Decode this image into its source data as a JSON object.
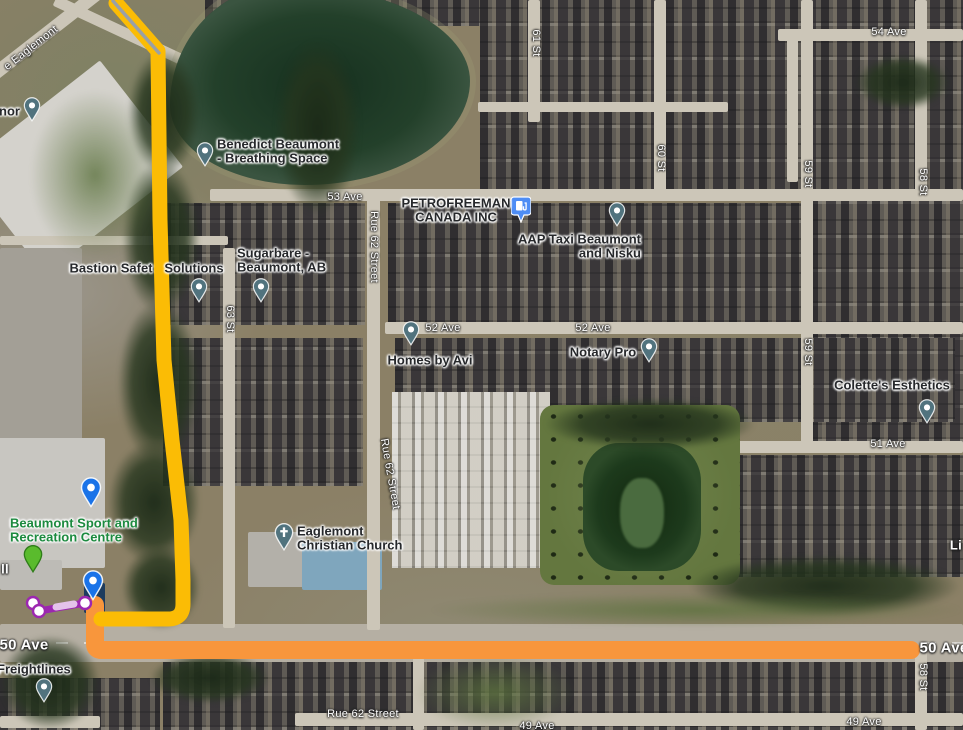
{
  "map": {
    "type": "google-maps-satellite-with-route",
    "width": 963,
    "height": 730
  },
  "colors": {
    "route_yellow": "#FBBC05",
    "route_orange": "#F8963C",
    "route_start_gray": "#9AA0A6",
    "walk_purple": "#9C27B0",
    "walk_purple_light": "#E4C2EA",
    "walk_node_fill": "#FFFFFF",
    "pin_blue": "#1A73E8",
    "pin_teal": "#51737E",
    "pin_green": "#5ABB2D",
    "pin_green_stroke": "#2F7D19",
    "pin_gas_blue": "#4E8DF5",
    "selected_building_navy": "#1D3C5E",
    "poi_text": "#26282B",
    "road_text": "#FFFFFF",
    "recreation_green": "#1C8A3F"
  },
  "road_labels": [
    {
      "t": "e Eaglemont",
      "x": 31,
      "y": 48,
      "r": -38
    },
    {
      "t": "54 Ave",
      "x": 889,
      "y": 32
    },
    {
      "t": "61 St",
      "x": 536,
      "y": 43,
      "r": 90
    },
    {
      "t": "60 St",
      "x": 661,
      "y": 158,
      "r": 90
    },
    {
      "t": "59 St",
      "x": 808,
      "y": 174,
      "r": 90
    },
    {
      "t": "58 St",
      "x": 923,
      "y": 182,
      "r": 90
    },
    {
      "t": "53 Ave",
      "x": 345,
      "y": 197
    },
    {
      "t": "Rue 62 Street",
      "x": 374,
      "y": 247,
      "r": 90
    },
    {
      "t": "52 Ave",
      "x": 443,
      "y": 328
    },
    {
      "t": "52 Ave",
      "x": 593,
      "y": 328
    },
    {
      "t": "63 St",
      "x": 230,
      "y": 319,
      "r": 90
    },
    {
      "t": "59 St",
      "x": 808,
      "y": 352,
      "r": 90
    },
    {
      "t": "51 Ave",
      "x": 888,
      "y": 444
    },
    {
      "t": "Rue 62 Street",
      "x": 390,
      "y": 474,
      "r": 80
    },
    {
      "t": "Li",
      "x": 956,
      "y": 545,
      "s": 13,
      "w": 700
    },
    {
      "t": "ll",
      "x": 5,
      "y": 569,
      "s": 13,
      "w": 700
    },
    {
      "t": "50 Ave",
      "x": 24,
      "y": 645,
      "s": 15,
      "w": 700
    },
    {
      "t": "50 Ave",
      "x": 944,
      "y": 648,
      "s": 15,
      "w": 700
    },
    {
      "t": "58 St",
      "x": 923,
      "y": 677,
      "r": 90
    },
    {
      "t": "Rue 62 Street",
      "x": 363,
      "y": 714
    },
    {
      "t": "49 Ave",
      "x": 537,
      "y": 726
    },
    {
      "t": "49 Ave",
      "x": 864,
      "y": 722
    }
  ],
  "place_labels": [
    {
      "n": "manor",
      "lines": [
        "nor"
      ],
      "x": 20,
      "y": 111,
      "align": "right"
    },
    {
      "n": "benedict-beaumont",
      "lines": [
        "Benedict Beaumont",
        "- Breathing Space"
      ],
      "x": 217,
      "y": 151,
      "align": "left"
    },
    {
      "n": "bastion-safety",
      "lines": [
        "Bastion Safet"
      ],
      "x": 111,
      "y": 268,
      "align": "center"
    },
    {
      "n": "bastion-solutions",
      "lines": [
        "Solutions"
      ],
      "x": 194,
      "y": 268,
      "align": "center"
    },
    {
      "n": "sugarbare",
      "lines": [
        "Sugarbare -",
        "Beaumont, AB"
      ],
      "x": 237,
      "y": 260,
      "align": "left"
    },
    {
      "n": "petrofreeman",
      "lines": [
        "PETROFREEMAN",
        "CANADA INC"
      ],
      "x": 456,
      "y": 210,
      "align": "center"
    },
    {
      "n": "aap-taxi",
      "lines": [
        "AAP Taxi Beaumont",
        "and Nisku"
      ],
      "x": 641,
      "y": 246,
      "align": "right"
    },
    {
      "n": "homes-by-avi",
      "lines": [
        "Homes by Avi"
      ],
      "x": 430,
      "y": 360,
      "align": "center"
    },
    {
      "n": "notary-pro",
      "lines": [
        "Notary Pro"
      ],
      "x": 603,
      "y": 352,
      "align": "center"
    },
    {
      "n": "colettes-esthetics",
      "lines": [
        "Colette's Esthetics"
      ],
      "x": 892,
      "y": 385,
      "align": "center"
    },
    {
      "n": "eaglemont-church",
      "lines": [
        "Eaglemont",
        "Christian Church"
      ],
      "x": 297,
      "y": 538,
      "align": "left"
    },
    {
      "n": "freightlines",
      "lines": [
        "Freightlines"
      ],
      "x": -3,
      "y": 669,
      "align": "left"
    },
    {
      "n": "recreation-centre",
      "lines": [
        "Beaumont Sport and",
        "Recreation Centre"
      ],
      "x": 10,
      "y": 530,
      "align": "left",
      "color": "#1C8A3F"
    }
  ],
  "pins": [
    {
      "n": "manor",
      "t": "teal",
      "x": 32,
      "y": 122
    },
    {
      "n": "benedict-beaumont",
      "t": "teal",
      "x": 205,
      "y": 167
    },
    {
      "n": "bastion-solutions",
      "t": "teal",
      "x": 199,
      "y": 303
    },
    {
      "n": "sugarbare",
      "t": "teal",
      "x": 261,
      "y": 303
    },
    {
      "n": "gas-station",
      "t": "gas",
      "x": 521,
      "y": 223
    },
    {
      "n": "aap-taxi",
      "t": "teal",
      "x": 617,
      "y": 227
    },
    {
      "n": "homes-by-avi",
      "t": "teal",
      "x": 411,
      "y": 346
    },
    {
      "n": "notary-pro",
      "t": "teal",
      "x": 649,
      "y": 363
    },
    {
      "n": "colettes-esthetics",
      "t": "teal",
      "x": 927,
      "y": 424
    },
    {
      "n": "eaglemont-church",
      "t": "church",
      "x": 284,
      "y": 552
    },
    {
      "n": "waypoint-north",
      "t": "blue",
      "x": 91,
      "y": 508
    },
    {
      "n": "waypoint-south",
      "t": "blue",
      "x": 93,
      "y": 601
    },
    {
      "n": "green-marker",
      "t": "green",
      "x": 33,
      "y": 574
    },
    {
      "n": "freightlines",
      "t": "teal",
      "x": 44,
      "y": 703
    }
  ],
  "routes": {
    "paths": [
      {
        "name": "route-orange-50ave",
        "d": "M95 605 L95 644 Q95 650 102 650 L911 650",
        "color": "#F8963C",
        "w": 18
      },
      {
        "name": "route-yellow-main",
        "d": "M116 3 L158 51 L160 220 L164 360 L172 440 L181 520 L183 580 L183 604 Q183 619 168 619 L101 619",
        "color": "#FBBC05",
        "w": 15
      },
      {
        "name": "route-start-gray",
        "d": "M113 1 L159 53",
        "color": "#9AA0A6",
        "w": 3.5
      },
      {
        "name": "route-walk-purple",
        "d": "M33 603 L39 611 L85 603",
        "color": "#9C27B0",
        "w": 7
      },
      {
        "name": "route-walk-light",
        "d": "M56 607 L74 604",
        "color": "#E4C2EA",
        "w": 7
      }
    ],
    "walk_nodes": [
      {
        "x": 33,
        "y": 603
      },
      {
        "x": 39,
        "y": 611
      },
      {
        "x": 85,
        "y": 603
      }
    ]
  },
  "map_features": {
    "zones": [
      {
        "x": 480,
        "y": 0,
        "w": 483,
        "h": 196
      },
      {
        "x": 205,
        "y": 0,
        "w": 275,
        "h": 26
      },
      {
        "x": 163,
        "y": 203,
        "w": 202,
        "h": 122
      },
      {
        "x": 388,
        "y": 203,
        "w": 575,
        "h": 122
      },
      {
        "x": 810,
        "y": 196,
        "w": 153,
        "h": 246
      },
      {
        "x": 163,
        "y": 338,
        "w": 200,
        "h": 148
      },
      {
        "x": 395,
        "y": 338,
        "w": 560,
        "h": 84
      },
      {
        "x": 392,
        "y": 392,
        "w": 158,
        "h": 176,
        "light": true
      },
      {
        "x": 735,
        "y": 455,
        "w": 228,
        "h": 122
      },
      {
        "x": 163,
        "y": 662,
        "w": 800,
        "h": 68
      },
      {
        "x": 0,
        "y": 678,
        "w": 160,
        "h": 52
      }
    ],
    "buildings": [
      {
        "n": "manor-building",
        "x": -15,
        "y": 100,
        "w": 175,
        "h": 135,
        "c": "#d4d2cc",
        "rot": -38
      },
      {
        "n": "parking-lot",
        "x": 0,
        "y": 248,
        "w": 82,
        "h": 212,
        "c": "#a39f96",
        "dash": true
      },
      {
        "n": "recreation-centre",
        "x": -10,
        "y": 438,
        "w": 115,
        "h": 130,
        "c": "#c8c6c1"
      },
      {
        "n": "rec-annex",
        "x": 0,
        "y": 560,
        "w": 62,
        "h": 30,
        "c": "#bdbbb6"
      },
      {
        "n": "church-building",
        "x": 248,
        "y": 532,
        "w": 58,
        "h": 55,
        "c": "#b3b0a9"
      },
      {
        "n": "church-blue-roof",
        "x": 302,
        "y": 542,
        "w": 80,
        "h": 48,
        "c": "#7fa6bd"
      },
      {
        "n": "selected-building",
        "x": 84,
        "y": 583,
        "w": 21,
        "h": 30,
        "c": "#1d3c5e"
      }
    ],
    "roads": [
      {
        "x": 210,
        "y": 189,
        "w": 753,
        "h": 12
      },
      {
        "x": 385,
        "y": 322,
        "w": 578,
        "h": 12
      },
      {
        "x": 735,
        "y": 441,
        "w": 228,
        "h": 12
      },
      {
        "x": 0,
        "y": 624,
        "w": 963,
        "h": 38,
        "main": true
      },
      {
        "x": 295,
        "y": 713,
        "w": 668,
        "h": 13
      },
      {
        "x": 0,
        "y": 716,
        "w": 100,
        "h": 12
      },
      {
        "x": 778,
        "y": 29,
        "w": 185,
        "h": 12
      },
      {
        "x": 787,
        "y": 34,
        "w": 11,
        "h": 148
      },
      {
        "x": 528,
        "y": 0,
        "w": 12,
        "h": 122
      },
      {
        "x": 654,
        "y": 0,
        "w": 12,
        "h": 196
      },
      {
        "x": 801,
        "y": 0,
        "w": 12,
        "h": 447
      },
      {
        "x": 915,
        "y": 0,
        "w": 12,
        "h": 196
      },
      {
        "x": 915,
        "y": 650,
        "w": 12,
        "h": 80
      },
      {
        "x": 223,
        "y": 248,
        "w": 12,
        "h": 380
      },
      {
        "x": 367,
        "y": 196,
        "w": 13,
        "h": 434
      },
      {
        "x": 413,
        "y": 658,
        "w": 11,
        "h": 72
      },
      {
        "x": 0,
        "y": 236,
        "w": 228,
        "h": 9
      },
      {
        "x": 478,
        "y": 102,
        "w": 250,
        "h": 10
      },
      {
        "x": -15,
        "y": 75,
        "w": 185,
        "h": 13,
        "rot": -38
      },
      {
        "x": 55,
        "y": -5,
        "w": 150,
        "h": 11,
        "rot": 25
      }
    ],
    "ponds": [
      {
        "cls": "park",
        "x": 540,
        "y": 405,
        "w": 200,
        "h": 180
      },
      {
        "cls": "pond-top",
        "x": 170,
        "y": -15,
        "w": 300,
        "h": 200
      },
      {
        "cls": "pond-ctr",
        "x": 583,
        "y": 443,
        "w": 118,
        "h": 128
      },
      {
        "cls": "island",
        "x": 620,
        "y": 478,
        "w": 44,
        "h": 70
      }
    ],
    "trees": [
      {
        "x": 128,
        "y": 50,
        "w": 72,
        "h": 125
      },
      {
        "x": 275,
        "y": 40,
        "w": 85,
        "h": 175
      },
      {
        "x": 122,
        "y": 160,
        "w": 78,
        "h": 155
      },
      {
        "x": 118,
        "y": 300,
        "w": 82,
        "h": 165
      },
      {
        "x": 108,
        "y": 440,
        "w": 92,
        "h": 125
      },
      {
        "x": 122,
        "y": 545,
        "w": 78,
        "h": 85
      },
      {
        "x": 545,
        "y": 398,
        "w": 210,
        "h": 52
      },
      {
        "x": 690,
        "y": 555,
        "w": 270,
        "h": 62
      },
      {
        "x": 0,
        "y": 635,
        "w": 100,
        "h": 95
      },
      {
        "x": 150,
        "y": 652,
        "w": 120,
        "h": 52
      },
      {
        "x": 855,
        "y": 55,
        "w": 95,
        "h": 55
      }
    ],
    "grass": [
      {
        "x": 430,
        "y": 593,
        "w": 533,
        "h": 34
      },
      {
        "x": 415,
        "y": 655,
        "w": 160,
        "h": 75
      },
      {
        "x": 30,
        "y": 90,
        "w": 130,
        "h": 170
      }
    ]
  }
}
